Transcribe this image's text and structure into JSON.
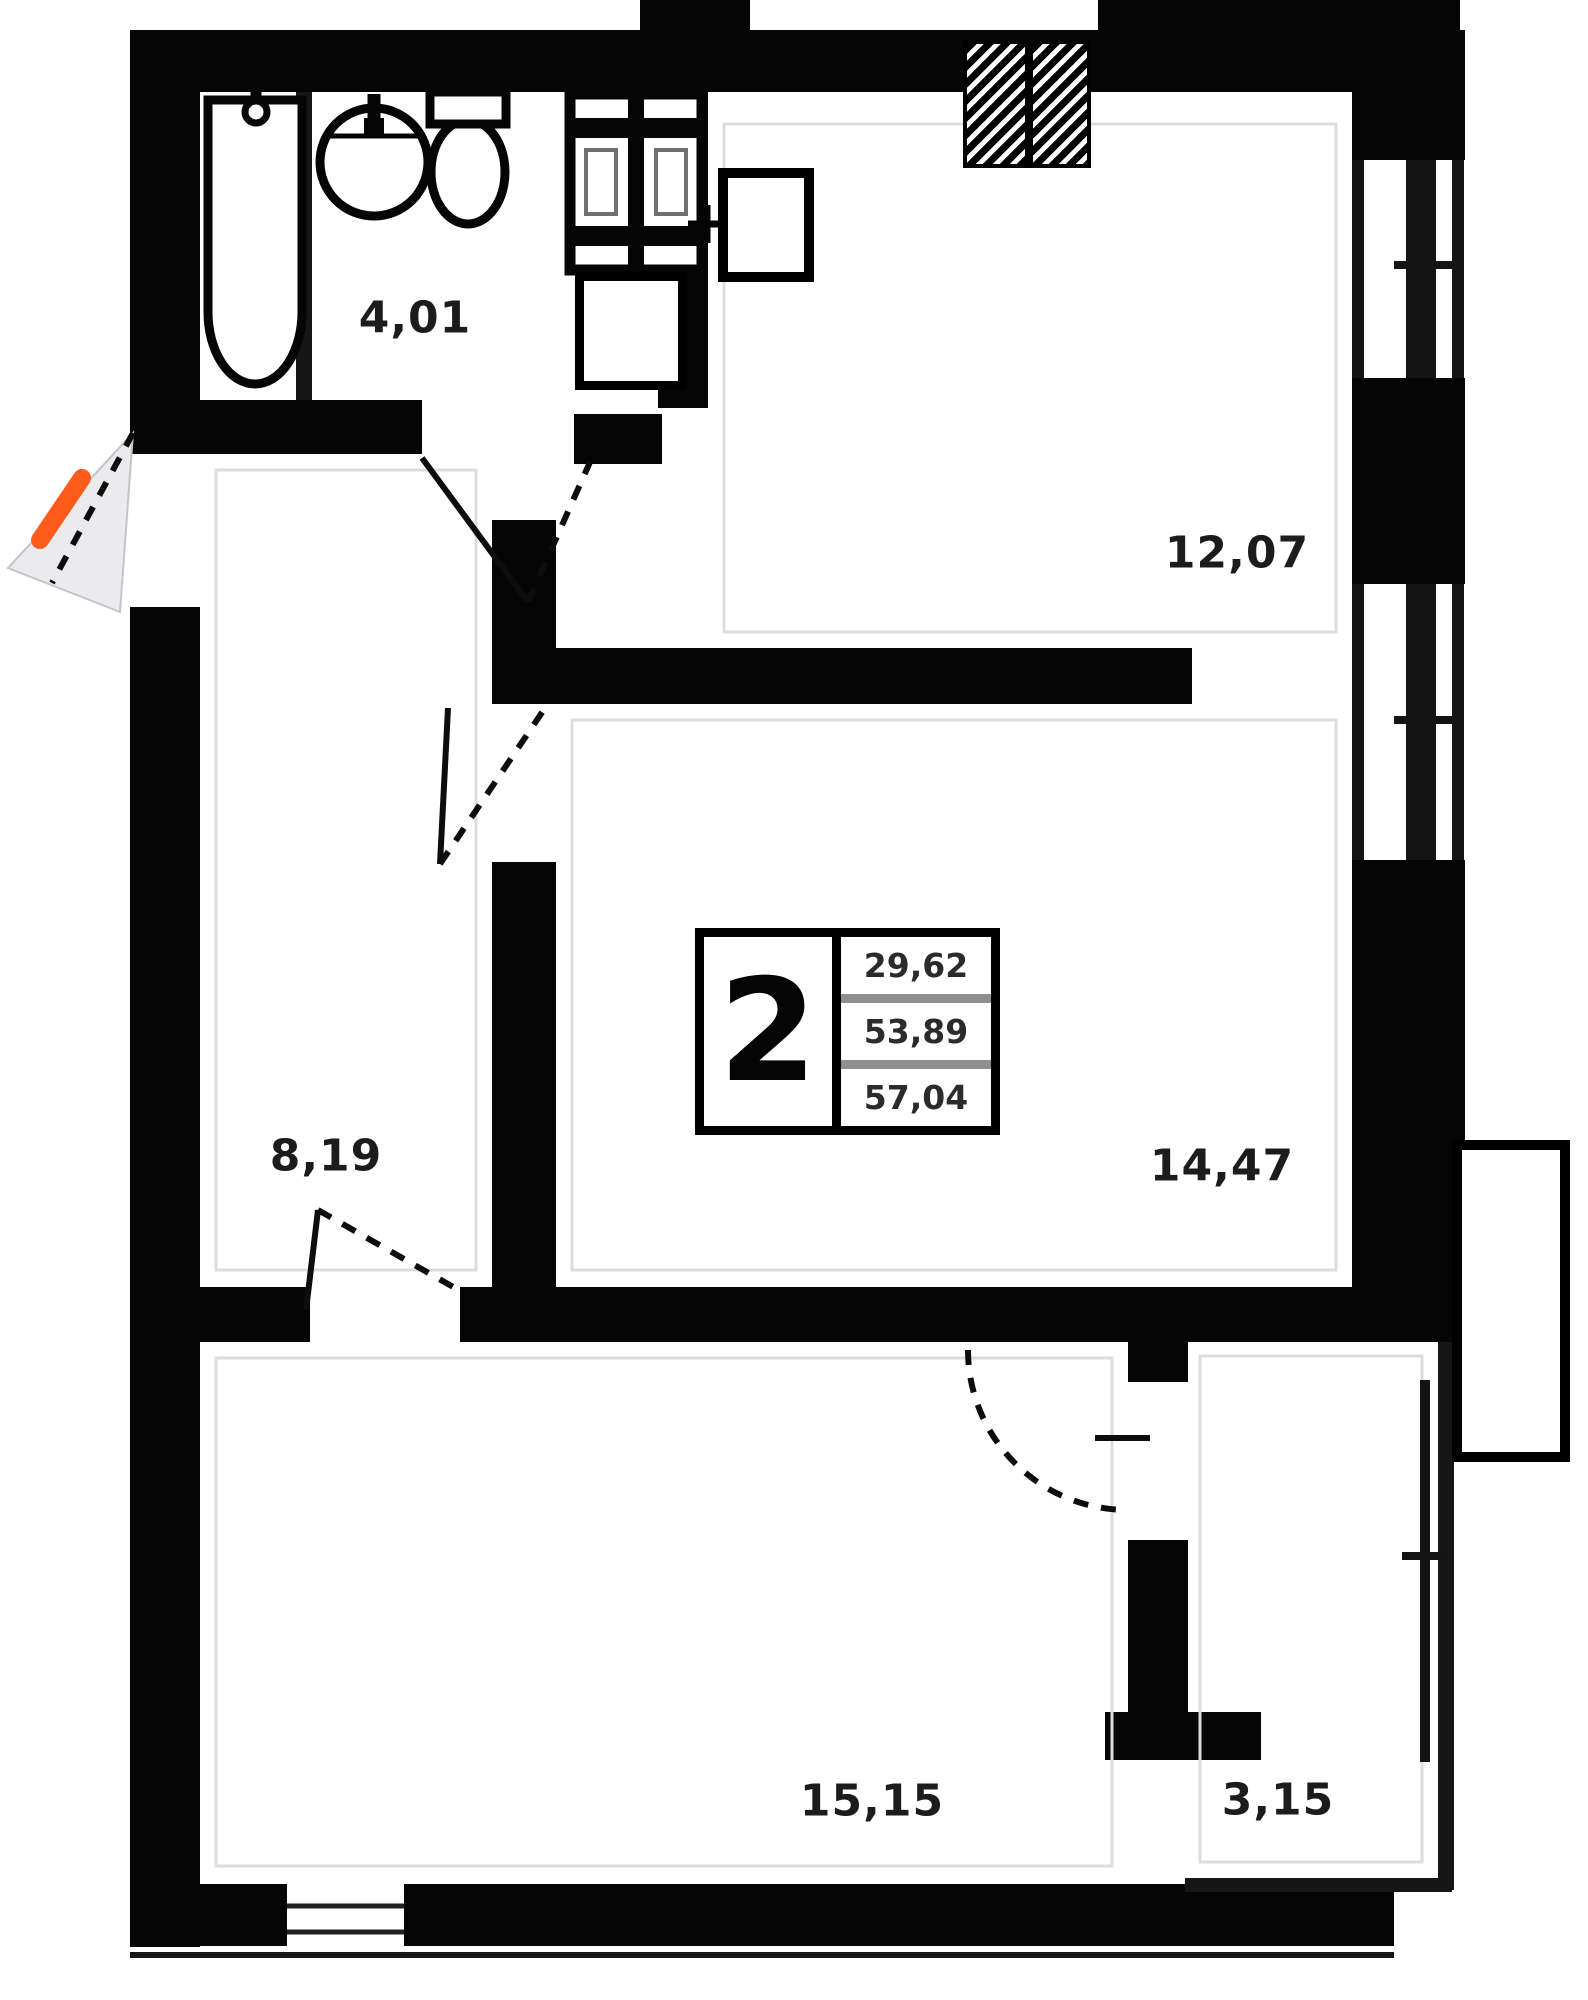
{
  "document": {
    "type": "apartment floor plan",
    "style": "2D black-wall plan"
  },
  "apartment": {
    "rooms_count": "2",
    "areas": {
      "living": "29,62",
      "apartment": "53,89",
      "total": "57,04"
    }
  },
  "rooms": [
    {
      "id": "bathroom",
      "area": "4,01"
    },
    {
      "id": "kitchen",
      "area": "12,07"
    },
    {
      "id": "hallway",
      "area": "8,19"
    },
    {
      "id": "bedroom",
      "area": "14,47"
    },
    {
      "id": "living-room",
      "area": "15,15"
    },
    {
      "id": "balcony",
      "area": "3,15"
    }
  ],
  "colors": {
    "wall": "#050505",
    "entrance_marker": "#ff5c1c",
    "door_swing_fill": "#ebebee",
    "inner_guide_line": "#dcdcdc"
  }
}
